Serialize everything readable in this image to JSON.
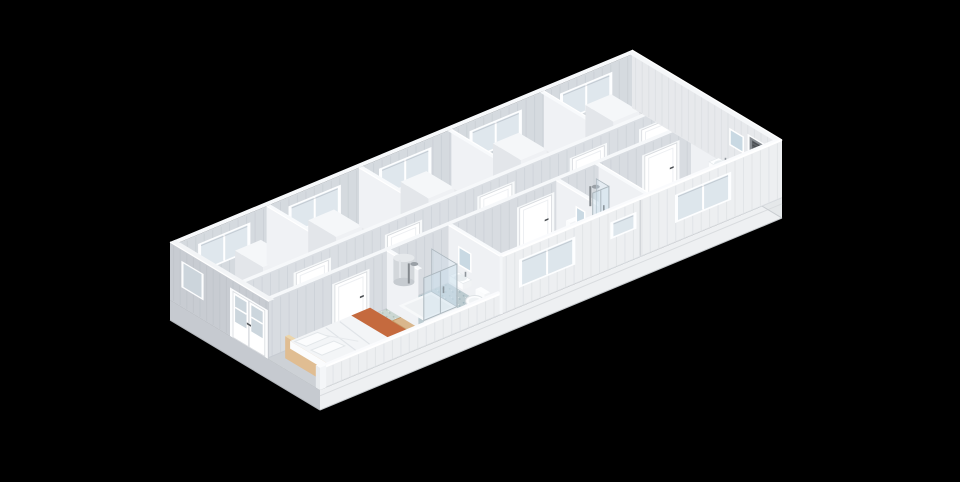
{
  "canvas": {
    "width": 960,
    "height": 482,
    "background": "#000000"
  },
  "palette": {
    "exterior_wall": "#edeff1",
    "interior_panel": "#d5dadf",
    "wall_top": "#f7f9fb",
    "west_end": "#c8ccd2",
    "east_end": "#e7e9ec",
    "floor_grey": "#e8eaed",
    "floor_sage": "#c9d5d2",
    "floor_blue": "#bccbd0",
    "glass": "#dde6ec",
    "bed_wood": "#d9b68c",
    "throw_orange": "#c56a3e",
    "vent_dark": "#5d6267",
    "door_white": "#ffffff",
    "handle_dark": "#4b4f53"
  },
  "scene": {
    "projection": {
      "origin": [
        170,
        300
      ],
      "u": [
        38.5,
        -16
      ],
      "v": [
        30,
        18
      ],
      "zpx": 22.3
    },
    "layers": [
      {
        "t": "plinth",
        "name": "base-plinth",
        "h": 0.9,
        "front": "#eef0f2",
        "east": "#e5e8ea",
        "west": "#c6cad0"
      },
      {
        "t": "floor",
        "name": "floor-slab",
        "r": [
          0,
          0,
          12,
          5
        ],
        "fill": "#e8eaed"
      },
      {
        "t": "floor",
        "name": "floor-corridor",
        "r": [
          0,
          2.35,
          12,
          3.25
        ],
        "fill": "#c7d2d2",
        "sp": "sage"
      },
      {
        "t": "floor",
        "name": "floor-bedroom",
        "r": [
          0,
          3.25,
          3.1,
          5
        ],
        "fill": "#cbd7d2",
        "sp": "sage"
      },
      {
        "t": "floor",
        "name": "floor-bathroom",
        "r": [
          3.1,
          3.25,
          4.7,
          5
        ],
        "fill": "#bccbd0",
        "sp": "blue"
      },
      {
        "t": "floor",
        "name": "floor-small-bathroom",
        "r": [
          7.5,
          3.25,
          8.6,
          5
        ],
        "fill": "#bccbd0",
        "sp": "blue"
      },
      {
        "t": "floor",
        "name": "floor-east-bathroom",
        "r": [
          11,
          3.25,
          12,
          5
        ],
        "fill": "#bccbd0",
        "sp": "blue"
      },
      {
        "t": "wallU",
        "name": "back-wall",
        "v": 0.14,
        "u1": 0,
        "u2": 12,
        "h": 2.6,
        "th": 0.14,
        "fill": "#d5dadf",
        "top": "#f7f9fb",
        "stripes": 1,
        "glass": "#dfe7ed",
        "windows": [
          {
            "a": 0.7,
            "b": 1.9,
            "z1": 0.95,
            "z2": 2.1,
            "panes": 2
          },
          {
            "a": 3.05,
            "b": 4.25,
            "z1": 0.95,
            "z2": 2.1,
            "panes": 2
          },
          {
            "a": 5.4,
            "b": 6.6,
            "z1": 0.95,
            "z2": 2.1,
            "panes": 2
          },
          {
            "a": 7.75,
            "b": 8.95,
            "z1": 0.95,
            "z2": 2.1,
            "panes": 2
          },
          {
            "a": 10.1,
            "b": 11.3,
            "z1": 0.95,
            "z2": 2.1,
            "panes": 2
          }
        ]
      },
      {
        "t": "wallV",
        "name": "west-end-wall-low",
        "u": 0,
        "v1": 3.3,
        "v2": 5,
        "th": 0.14,
        "fill": "#cdd1d6",
        "top": "#f3f5f7",
        "topProfile": [
          [
            3.3,
            2.6
          ],
          [
            4.3,
            0.95
          ],
          [
            5,
            0.95
          ]
        ]
      },
      {
        "t": "box",
        "name": "wardrobe",
        "r": [
          0.95,
          0.95,
          1.62,
          1.88
        ],
        "z0": 0,
        "z1": 2.3,
        "top": "#f5f7f9",
        "front": "#eff1f4",
        "side": "#e3e6ea"
      },
      {
        "t": "wallV",
        "name": "partition-wall",
        "u": 2.4,
        "v1": 0.14,
        "v2": 2.35,
        "h": 2.6,
        "th": 0.1,
        "side": "w",
        "fill": "#f0f2f5",
        "top": "#f8fafc"
      },
      {
        "t": "box",
        "name": "wardrobe",
        "r": [
          2.85,
          0.95,
          3.52,
          1.88
        ],
        "z0": 0,
        "z1": 2.3,
        "top": "#f5f7f9",
        "front": "#eff1f4",
        "side": "#e3e6ea"
      },
      {
        "t": "wallV",
        "name": "partition-wall",
        "u": 4.8,
        "v1": 0.14,
        "v2": 2.35,
        "h": 2.6,
        "th": 0.1,
        "side": "w",
        "fill": "#f0f2f5",
        "top": "#f8fafc"
      },
      {
        "t": "box",
        "name": "wardrobe",
        "r": [
          5.25,
          0.95,
          5.92,
          1.88
        ],
        "z0": 0,
        "z1": 2.3,
        "top": "#f5f7f9",
        "front": "#eff1f4",
        "side": "#e3e6ea"
      },
      {
        "t": "wallV",
        "name": "partition-wall",
        "u": 7.2,
        "v1": 0.14,
        "v2": 2.35,
        "h": 2.6,
        "th": 0.1,
        "side": "e",
        "fill": "#f0f2f5",
        "top": "#f8fafc"
      },
      {
        "t": "box",
        "name": "wardrobe",
        "r": [
          7.65,
          0.95,
          8.32,
          1.88
        ],
        "z0": 0,
        "z1": 2.3,
        "top": "#f5f7f9",
        "front": "#eff1f4",
        "side": "#e3e6ea"
      },
      {
        "t": "wallV",
        "name": "partition-wall",
        "u": 9.6,
        "v1": 0.14,
        "v2": 2.35,
        "h": 2.6,
        "th": 0.1,
        "side": "e",
        "fill": "#f0f2f5",
        "top": "#f8fafc"
      },
      {
        "t": "box",
        "name": "wardrobe",
        "r": [
          10.05,
          0.95,
          10.72,
          1.88
        ],
        "z0": 0,
        "z1": 2.3,
        "top": "#f5f7f9",
        "front": "#eff1f4",
        "side": "#e3e6ea"
      },
      {
        "t": "wallU",
        "name": "corridor-wall-back",
        "v": 2.35,
        "u1": 0,
        "u2": 12,
        "h": 2.6,
        "th": 0.12,
        "fill": "#dadee3",
        "top": "#f6f8fa",
        "stripes": 1,
        "doors": [
          {
            "a": 1.45,
            "b": 2.28
          },
          {
            "a": 3.82,
            "b": 4.65
          },
          {
            "a": 6.22,
            "b": 7.05
          },
          {
            "a": 8.62,
            "b": 9.45
          },
          {
            "a": 10.42,
            "b": 11.25
          }
        ]
      },
      {
        "t": "wallU",
        "name": "corridor-wall-front",
        "v": 3.25,
        "u1": 0,
        "u2": 12,
        "h": 2.6,
        "th": 0.12,
        "fill": "#d8dce1",
        "top": "#f6f8fa",
        "stripes": 1,
        "doors": [
          {
            "a": 1.75,
            "b": 2.58
          },
          {
            "a": 6.55,
            "b": 7.38
          },
          {
            "a": 9.8,
            "b": 10.63
          }
        ]
      },
      {
        "t": "wallV",
        "name": "west-end-wall",
        "u": 0,
        "v1": 0,
        "v2": 3.3,
        "h": 2.6,
        "th": 0.14,
        "side": "w",
        "fill": "#c8ccd2",
        "top": "#f3f5f7",
        "stripes": 1,
        "window": {
          "a": 0.45,
          "b": 1.05,
          "z1": 0.95,
          "z2": 2.0,
          "glass": "#ccd5dc"
        },
        "french": {
          "a": 2.08,
          "b": 3.18,
          "z2": 2.08,
          "glass": "#ccd6dd"
        }
      },
      {
        "t": "bed",
        "name": "bed",
        "frame": [
          0.28,
          3.48,
          2.5,
          4.82
        ],
        "frameZ": 0.42,
        "headZ": 0.98,
        "headW": 0.1,
        "matt": [
          0.36,
          3.54,
          2.44,
          4.78
        ],
        "mattZ": [
          0.42,
          0.76
        ],
        "wood": [
          "#cfa26e",
          "#e0bd92",
          "#ecd6ab"
        ],
        "linen": [
          "#f3f5f7",
          "#e9ecef",
          "#fbfcfd"
        ],
        "throw": [
          "#c56a3e",
          "#aa562e",
          "#9d4f2a"
        ],
        "throwU": 1.95
      },
      {
        "t": "bench",
        "name": "bedside-bench",
        "r": [
          2.62,
          4.05,
          2.92,
          4.6
        ],
        "z": 0.45,
        "top": "#d9b68c",
        "leg": "#a85430"
      },
      {
        "t": "wallV",
        "name": "bathroom-partition",
        "u": 3.1,
        "v1": 3.25,
        "v2": 4.3,
        "h": 2.6,
        "th": 0.1,
        "side": "w",
        "fill": "#f0f2f5",
        "top": "#f8fafc"
      },
      {
        "t": "boiler",
        "name": "water-heater",
        "u": 3.24,
        "v": 3.64,
        "z": 1.42,
        "h": 1.08
      },
      {
        "t": "wallV",
        "name": "bathroom-partition",
        "u": 4.7,
        "v1": 3.25,
        "v2": 5,
        "h": 2.6,
        "th": 0.1,
        "side": "w",
        "fill": "#eff1f4",
        "top": "#f8fafc"
      },
      {
        "t": "mirror",
        "name": "bathroom-mirror",
        "u": 4.68,
        "v1": 3.62,
        "v2": 4.02,
        "z1": 1.15,
        "z2": 1.95
      },
      {
        "t": "sink",
        "name": "washbasin",
        "r": [
          4.46,
          3.6,
          4.68,
          4.04
        ],
        "z0": 0.52,
        "z1": 0.8
      },
      {
        "t": "toilet",
        "name": "toilet",
        "tank": [
          4.54,
          4.36,
          4.68,
          4.66,
          0.3,
          0.75
        ],
        "bowl": [
          4.4,
          4.51,
          9,
          5.5
        ]
      },
      {
        "t": "shower",
        "name": "shower-cabin",
        "r": [
          3.32,
          3.36,
          4.18,
          4.2
        ]
      },
      {
        "t": "wallV",
        "name": "partition-wall",
        "u": 7.5,
        "v1": 3.25,
        "v2": 5,
        "h": 2.6,
        "th": 0.1,
        "side": "w",
        "fill": "#eff1f4",
        "top": "#f8fafc"
      },
      {
        "t": "wallV",
        "name": "partition-wall",
        "u": 8.6,
        "v1": 3.25,
        "v2": 5,
        "h": 2.6,
        "th": 0.1,
        "side": "e",
        "fill": "#eff1f4",
        "top": "#f8fafc"
      },
      {
        "t": "toilet",
        "name": "toilet",
        "tank": [
          7.7,
          3.32,
          7.94,
          3.46,
          0.3,
          0.72
        ],
        "bowl": [
          7.82,
          3.62,
          8,
          5
        ]
      },
      {
        "t": "shower",
        "name": "shower-cabin",
        "r": [
          8.08,
          3.3,
          8.5,
          3.72
        ]
      },
      {
        "t": "sink",
        "name": "washbasin",
        "r": [
          7.56,
          3.82,
          7.74,
          4.12
        ],
        "z0": 0.52,
        "z1": 0.78
      },
      {
        "t": "mirror",
        "name": "bathroom-mirror",
        "u": 7.56,
        "v1": 3.84,
        "v2": 4.12,
        "z1": 1.15,
        "z2": 1.85
      },
      {
        "t": "wallV",
        "name": "partition-wall",
        "u": 11,
        "v1": 3.25,
        "v2": 5,
        "h": 2.6,
        "th": 0.1,
        "side": "e",
        "fill": "#eff1f4",
        "top": "#f8fafc"
      },
      {
        "t": "wallV",
        "name": "east-end-wall",
        "u": 12,
        "v1": 0,
        "v2": 5,
        "h": 2.6,
        "th": 0.14,
        "side": "e",
        "fill": "#e7e9ec",
        "top": "#f5f7f9",
        "stripes": 1,
        "window": {
          "a": 3.92,
          "b": 4.58,
          "z1": 1.28,
          "z2": 1.88,
          "glass": "#888d93",
          "grille": 1
        }
      },
      {
        "t": "sink",
        "name": "washbasin",
        "r": [
          11.35,
          3.4,
          11.6,
          3.85
        ],
        "z0": 0.52,
        "z1": 0.8
      },
      {
        "t": "mirror",
        "name": "bathroom-mirror",
        "u": 11.88,
        "v1": 3.42,
        "v2": 3.86,
        "z1": 1.2,
        "z2": 1.9
      },
      {
        "t": "toilet",
        "name": "toilet",
        "tank": [
          11.6,
          4.25,
          11.76,
          4.55,
          0.3,
          0.72
        ],
        "bowl": [
          11.45,
          4.4,
          8.5,
          5
        ]
      },
      {
        "t": "wallU",
        "name": "front-wall-low",
        "v": 5,
        "u1": 0,
        "u2": 4.72,
        "h": 0.95,
        "th": 0.12,
        "fill": "#edeff1",
        "top": "#fafbfd",
        "stripes": 1,
        "edgeTop": 1
      },
      {
        "t": "wallU",
        "name": "front-wall",
        "v": 5,
        "u1": 4.72,
        "u2": 12,
        "h": 2.6,
        "th": 0.12,
        "fill": "#edeff1",
        "top": "#fafbfd",
        "stripes": 1,
        "edgeTop": 1,
        "joint": 8.32,
        "leftEdge": 1,
        "glass": "#dde6ec",
        "windows": [
          {
            "a": 5.25,
            "b": 6.55,
            "z1": 0.95,
            "z2": 2.05,
            "panes": 2
          },
          {
            "a": 7.62,
            "b": 8.14,
            "z1": 1.42,
            "z2": 2.02,
            "panes": 1
          },
          {
            "a": 9.3,
            "b": 10.6,
            "z1": 0.95,
            "z2": 2.05,
            "panes": 2
          }
        ]
      },
      {
        "t": "box",
        "name": "corner-post",
        "r": [
          0,
          4.86,
          0.16,
          5
        ],
        "z0": 0,
        "z1": 1.0,
        "top": "#fbfcfd",
        "front": "#f4f6f8",
        "side": "#e9ecef"
      }
    ]
  }
}
